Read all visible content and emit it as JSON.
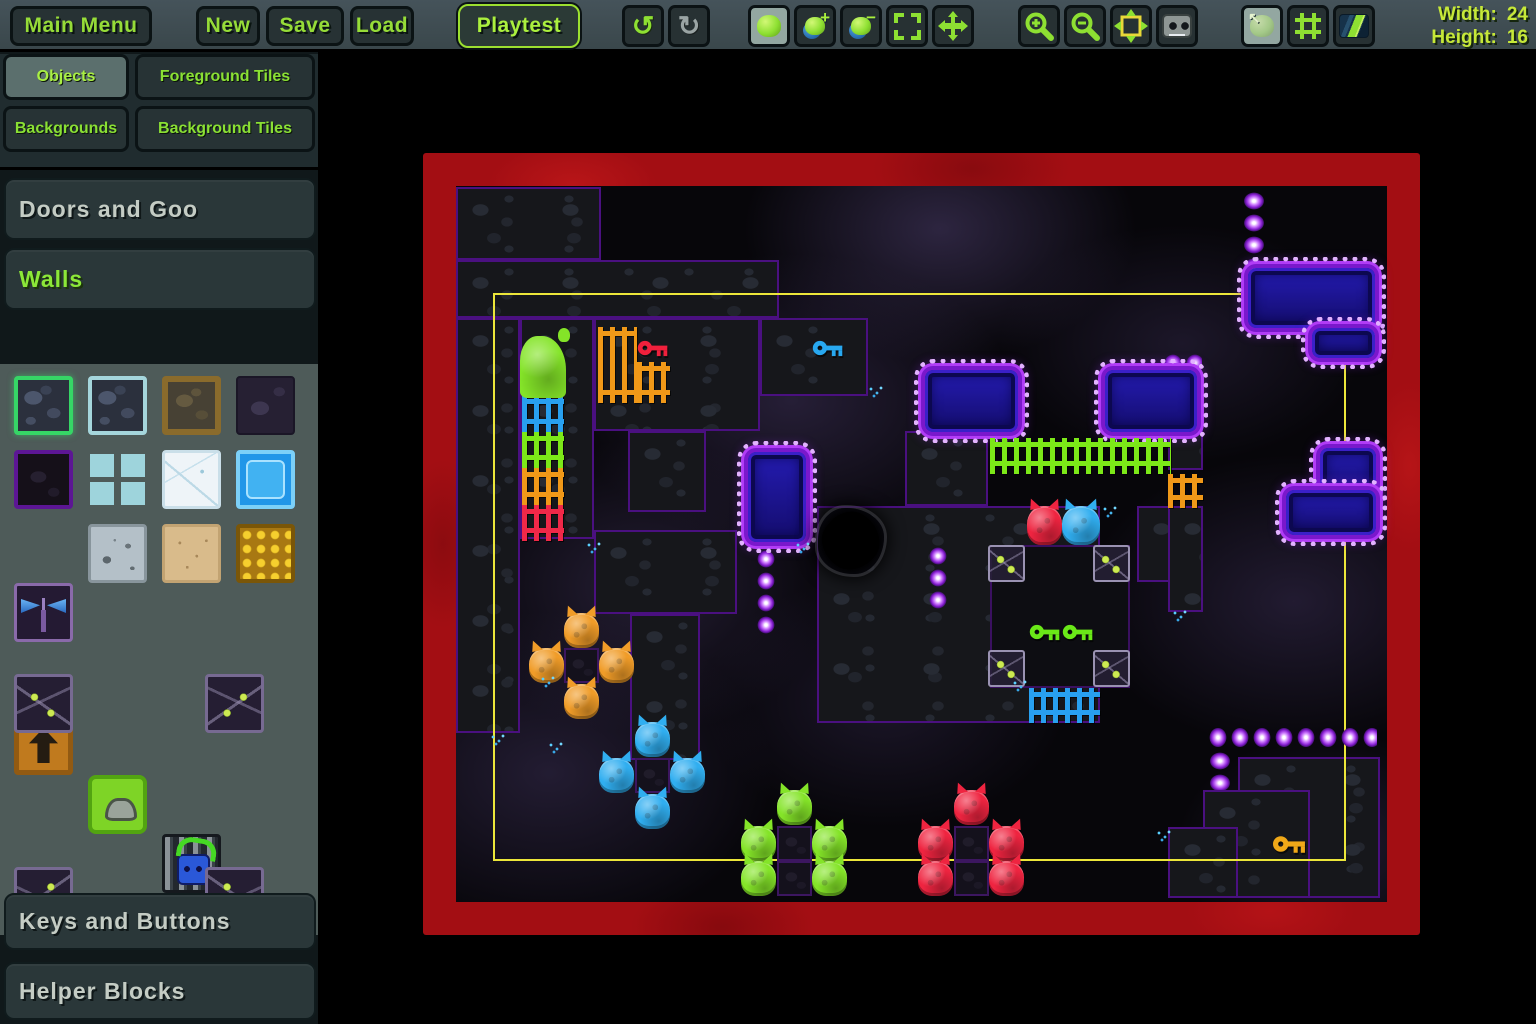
{
  "toolbar": {
    "buttons": [
      {
        "label": "Main Menu",
        "x": 10,
        "w": 142,
        "name": "main-menu-button"
      },
      {
        "label": "New",
        "x": 196,
        "w": 64,
        "name": "new-button"
      },
      {
        "label": "Save",
        "x": 266,
        "w": 78,
        "name": "save-button"
      },
      {
        "label": "Load",
        "x": 350,
        "w": 64,
        "name": "load-button"
      },
      {
        "label": "Playtest",
        "x": 458,
        "w": 122,
        "style": "playtest",
        "name": "playtest-button"
      }
    ],
    "icon_groups": [
      {
        "x": 622,
        "items": [
          {
            "icon": "undo",
            "enabled": true
          },
          {
            "icon": "redo",
            "enabled": false
          }
        ]
      },
      {
        "x": 748,
        "items": [
          {
            "icon": "brush-blob",
            "sel": true
          },
          {
            "icon": "blob-add"
          },
          {
            "icon": "blob-remove"
          },
          {
            "icon": "marquee-select"
          },
          {
            "icon": "move-view"
          }
        ]
      },
      {
        "x": 1018,
        "items": [
          {
            "icon": "zoom-in"
          },
          {
            "icon": "zoom-out"
          },
          {
            "icon": "fit-view"
          },
          {
            "icon": "toggle-faces"
          }
        ]
      },
      {
        "x": 1241,
        "items": [
          {
            "icon": "objects-layer",
            "sel": true
          },
          {
            "icon": "grid-toggle"
          },
          {
            "icon": "background-toggle"
          }
        ]
      }
    ],
    "size_info": {
      "width_label": "Width:",
      "width_value": "24",
      "height_label": "Height:",
      "height_value": "16"
    }
  },
  "sidebar": {
    "tabs": [
      {
        "label": "Objects",
        "x": 3,
        "y": 8,
        "w": 126,
        "h": 46,
        "sel": true
      },
      {
        "label": "Foreground Tiles",
        "x": 135,
        "y": 8,
        "w": 180,
        "h": 46
      },
      {
        "label": "Backgrounds",
        "x": 3,
        "y": 60,
        "w": 126,
        "h": 46
      },
      {
        "label": "Background Tiles",
        "x": 135,
        "y": 60,
        "w": 180,
        "h": 46
      }
    ],
    "sections": [
      {
        "label": "Doors and Goo",
        "y": 126,
        "h": 62,
        "expanded": false
      },
      {
        "label": "Walls",
        "y": 196,
        "h": 62,
        "expanded": true
      },
      {
        "label": "Keys and Buttons",
        "y": 841,
        "h": 57,
        "expanded": false
      },
      {
        "label": "Helper Blocks",
        "y": 910,
        "h": 58,
        "expanded": false
      }
    ],
    "palette": [
      {
        "n": "rock-green",
        "x": 14,
        "y": 272,
        "rock": true,
        "sel": true
      },
      {
        "n": "rock-crystal",
        "x": 88,
        "y": 272,
        "rock": true
      },
      {
        "n": "dirt-brown",
        "x": 162,
        "y": 272
      },
      {
        "n": "rock-shadow",
        "x": 236,
        "y": 272
      },
      {
        "n": "rock-purple",
        "x": 14,
        "y": 346
      },
      {
        "n": "mini-rocks",
        "x": 88,
        "y": 346
      },
      {
        "n": "ice-white",
        "x": 162,
        "y": 346
      },
      {
        "n": "ice-blue",
        "x": 236,
        "y": 346
      },
      {
        "n": "moth-block",
        "x": 14,
        "y": 420
      },
      {
        "n": "concrete",
        "x": 88,
        "y": 420
      },
      {
        "n": "sand",
        "x": 162,
        "y": 420
      },
      {
        "n": "honeycomb",
        "x": 236,
        "y": 420
      },
      {
        "n": "arrow-block",
        "x": 14,
        "y": 494
      },
      {
        "n": "goo-block",
        "x": 88,
        "y": 494
      },
      {
        "n": "door-block",
        "x": 162,
        "y": 494
      },
      {
        "n": "vine-corner",
        "variant": "v-tl",
        "x": 14,
        "y": 570
      },
      {
        "n": "vine-corner",
        "variant": "v-tr",
        "x": 205,
        "y": 570
      },
      {
        "n": "vine-corner",
        "variant": "v-bl",
        "x": 14,
        "y": 763
      },
      {
        "n": "vine-corner",
        "variant": "v-br",
        "x": 205,
        "y": 763
      }
    ]
  },
  "canvas": {
    "width_tiles": 24,
    "height_tiles": 16,
    "frame_color": "#a30e13",
    "bounds_color": "#ece63a",
    "objects": [
      {
        "n": "rock-region",
        "t": "rock",
        "x": 0,
        "y": 1,
        "w": 145,
        "h": 73
      },
      {
        "n": "rock-region",
        "t": "rock",
        "x": 0,
        "y": 74,
        "w": 323,
        "h": 58
      },
      {
        "n": "rock-region",
        "t": "rock",
        "x": 0,
        "y": 132,
        "w": 64,
        "h": 415
      },
      {
        "n": "rock-region",
        "t": "rock",
        "x": 64,
        "y": 132,
        "w": 74,
        "h": 221
      },
      {
        "n": "rock-region",
        "t": "rock",
        "x": 138,
        "y": 132,
        "w": 166,
        "h": 113
      },
      {
        "n": "rock-region",
        "t": "rock",
        "x": 304,
        "y": 132,
        "w": 108,
        "h": 78
      },
      {
        "n": "rock-region",
        "t": "rock",
        "x": 172,
        "y": 245,
        "w": 78,
        "h": 81
      },
      {
        "n": "rock-region",
        "t": "rock",
        "x": 138,
        "y": 344,
        "w": 143,
        "h": 84
      },
      {
        "n": "rock-region",
        "t": "rock",
        "x": 174,
        "y": 428,
        "w": 70,
        "h": 146
      },
      {
        "n": "rock-region",
        "t": "rock",
        "x": 449,
        "y": 245,
        "w": 83,
        "h": 75
      },
      {
        "n": "rock-region",
        "t": "rock",
        "x": 361,
        "y": 320,
        "w": 283,
        "h": 217
      },
      {
        "n": "rock-region",
        "t": "rock",
        "x": 681,
        "y": 320,
        "w": 35,
        "h": 76
      },
      {
        "n": "rock-region",
        "t": "rock",
        "x": 712,
        "y": 214,
        "w": 35,
        "h": 70
      },
      {
        "n": "rock-region",
        "t": "rock",
        "x": 712,
        "y": 320,
        "w": 35,
        "h": 106
      },
      {
        "n": "rock-region",
        "t": "rock",
        "x": 782,
        "y": 571,
        "w": 142,
        "h": 141
      },
      {
        "n": "rock-region",
        "t": "rock",
        "x": 747,
        "y": 604,
        "w": 107,
        "h": 108
      },
      {
        "n": "rock-region",
        "t": "rock",
        "x": 712,
        "y": 641,
        "w": 70,
        "h": 71
      },
      {
        "n": "black-room",
        "t": "blackpatch",
        "x": 534,
        "y": 359,
        "w": 140,
        "h": 143
      },
      {
        "n": "level-bounds",
        "t": "bounds",
        "x": 37,
        "y": 107,
        "w": 853,
        "h": 568
      },
      {
        "n": "diamond-chain",
        "t": "chainV",
        "x": 785,
        "y": 4,
        "w": 26,
        "h": 103
      },
      {
        "n": "diamond-chain",
        "t": "chainV",
        "x": 471,
        "y": 359,
        "w": 22,
        "h": 67
      },
      {
        "n": "diamond-chain",
        "t": "chainV",
        "x": 299,
        "y": 362,
        "w": 22,
        "h": 87
      },
      {
        "n": "diamond-chain",
        "t": "chainH",
        "x": 751,
        "y": 539,
        "w": 170,
        "h": 25
      },
      {
        "n": "diamond-chain",
        "t": "chainV",
        "x": 751,
        "y": 564,
        "w": 26,
        "h": 40
      },
      {
        "n": "diamond-chain",
        "t": "chainH",
        "x": 706,
        "y": 166,
        "w": 40,
        "h": 22
      },
      {
        "n": "spike-wall",
        "t": "spike",
        "x": 469,
        "y": 184,
        "w": 93,
        "h": 62
      },
      {
        "n": "spike-wall",
        "t": "spike",
        "x": 649,
        "y": 184,
        "w": 92,
        "h": 62
      },
      {
        "n": "spike-wall",
        "t": "spike",
        "x": 292,
        "y": 266,
        "w": 58,
        "h": 90
      },
      {
        "n": "spike-wall",
        "t": "spike",
        "x": 792,
        "y": 82,
        "w": 127,
        "h": 60
      },
      {
        "n": "spike-wall",
        "t": "spike",
        "x": 856,
        "y": 142,
        "w": 63,
        "h": 30
      },
      {
        "n": "spike-wall",
        "t": "spike",
        "x": 864,
        "y": 262,
        "w": 56,
        "h": 52
      },
      {
        "n": "spike-wall",
        "t": "spike",
        "x": 830,
        "y": 304,
        "w": 90,
        "h": 45
      },
      {
        "n": "splat",
        "t": "splat",
        "x": 362,
        "y": 322,
        "w": 66,
        "h": 66
      },
      {
        "n": "fence-green",
        "t": "fence",
        "x": 534,
        "y": 252,
        "w": 181,
        "h": 36,
        "c": "#7ce818"
      },
      {
        "n": "fence-orange",
        "t": "fence",
        "x": 712,
        "y": 288,
        "w": 35,
        "h": 34,
        "c": "#f09818"
      },
      {
        "n": "fence-blue",
        "t": "fence",
        "x": 573,
        "y": 502,
        "w": 71,
        "h": 35,
        "c": "#28a0f0"
      },
      {
        "n": "fence-orange",
        "t": "fence",
        "x": 142,
        "y": 141,
        "w": 39,
        "h": 76,
        "c": "#f09818"
      },
      {
        "n": "fence-orange",
        "t": "fence",
        "x": 181,
        "y": 176,
        "w": 33,
        "h": 41,
        "c": "#f09818"
      },
      {
        "n": "goo-ladder",
        "t": "ladder",
        "x": 66,
        "y": 209,
        "w": 42,
        "h": 146,
        "segs": [
          "#28a0f0",
          "#7ce818",
          "#f09818",
          "#f02848"
        ]
      },
      {
        "n": "goo-drip-green",
        "t": "gooDrip",
        "x": 64,
        "y": 150,
        "w": 46,
        "h": 62,
        "c": "#84e428"
      },
      {
        "n": "vine-tile",
        "t": "vine",
        "x": 532,
        "y": 359,
        "w": 37,
        "h": 37
      },
      {
        "n": "vine-tile",
        "t": "vine",
        "x": 637,
        "y": 359,
        "w": 37,
        "h": 37
      },
      {
        "n": "vine-tile",
        "t": "vine",
        "x": 532,
        "y": 464,
        "w": 37,
        "h": 37
      },
      {
        "n": "vine-tile",
        "t": "vine",
        "x": 637,
        "y": 464,
        "w": 37,
        "h": 37
      },
      {
        "n": "dark-tile",
        "t": "darktile",
        "x": 108,
        "y": 462,
        "w": 35,
        "h": 35
      },
      {
        "n": "dark-tile",
        "t": "darktile",
        "x": 179,
        "y": 572,
        "w": 35,
        "h": 35
      },
      {
        "n": "dark-tile",
        "t": "darktile",
        "x": 321,
        "y": 640,
        "w": 35,
        "h": 35
      },
      {
        "n": "dark-tile",
        "t": "darktile",
        "x": 321,
        "y": 675,
        "w": 35,
        "h": 35
      },
      {
        "n": "dark-tile",
        "t": "darktile",
        "x": 498,
        "y": 640,
        "w": 35,
        "h": 35
      },
      {
        "n": "dark-tile",
        "t": "darktile",
        "x": 498,
        "y": 675,
        "w": 35,
        "h": 35
      },
      {
        "n": "goo-red",
        "t": "goo",
        "x": 571,
        "y": 320,
        "w": 35,
        "h": 39,
        "c": "#ef2440"
      },
      {
        "n": "goo-blue",
        "t": "goo",
        "x": 606,
        "y": 320,
        "w": 38,
        "h": 39,
        "c": "#30aef0"
      },
      {
        "n": "goo-orange",
        "t": "goo",
        "x": 108,
        "y": 427,
        "w": 35,
        "h": 35,
        "c": "#f09c28"
      },
      {
        "n": "goo-orange",
        "t": "goo",
        "x": 73,
        "y": 462,
        "w": 35,
        "h": 35,
        "c": "#f09c28"
      },
      {
        "n": "goo-orange",
        "t": "goo",
        "x": 143,
        "y": 462,
        "w": 35,
        "h": 35,
        "c": "#f09c28"
      },
      {
        "n": "goo-orange",
        "t": "goo",
        "x": 108,
        "y": 498,
        "w": 35,
        "h": 35,
        "c": "#f09c28"
      },
      {
        "n": "goo-blue",
        "t": "goo",
        "x": 179,
        "y": 536,
        "w": 35,
        "h": 35,
        "c": "#30aef0"
      },
      {
        "n": "goo-blue",
        "t": "goo",
        "x": 143,
        "y": 572,
        "w": 35,
        "h": 35,
        "c": "#30aef0"
      },
      {
        "n": "goo-blue",
        "t": "goo",
        "x": 214,
        "y": 572,
        "w": 35,
        "h": 35,
        "c": "#30aef0"
      },
      {
        "n": "goo-blue",
        "t": "goo",
        "x": 179,
        "y": 608,
        "w": 35,
        "h": 35,
        "c": "#30aef0"
      },
      {
        "n": "goo-green",
        "t": "goo",
        "x": 321,
        "y": 604,
        "w": 35,
        "h": 35,
        "c": "#84e428"
      },
      {
        "n": "goo-green",
        "t": "goo",
        "x": 285,
        "y": 640,
        "w": 35,
        "h": 35,
        "c": "#84e428"
      },
      {
        "n": "goo-green",
        "t": "goo",
        "x": 356,
        "y": 640,
        "w": 35,
        "h": 35,
        "c": "#84e428"
      },
      {
        "n": "goo-green",
        "t": "goo",
        "x": 285,
        "y": 675,
        "w": 35,
        "h": 35,
        "c": "#84e428"
      },
      {
        "n": "goo-green",
        "t": "goo",
        "x": 356,
        "y": 675,
        "w": 35,
        "h": 35,
        "c": "#84e428"
      },
      {
        "n": "goo-red",
        "t": "goo",
        "x": 498,
        "y": 604,
        "w": 35,
        "h": 35,
        "c": "#ef2440"
      },
      {
        "n": "goo-red",
        "t": "goo",
        "x": 462,
        "y": 640,
        "w": 35,
        "h": 35,
        "c": "#ef2440"
      },
      {
        "n": "goo-red",
        "t": "goo",
        "x": 533,
        "y": 640,
        "w": 35,
        "h": 35,
        "c": "#ef2440"
      },
      {
        "n": "goo-red",
        "t": "goo",
        "x": 462,
        "y": 675,
        "w": 35,
        "h": 35,
        "c": "#ef2440"
      },
      {
        "n": "goo-red",
        "t": "goo",
        "x": 533,
        "y": 675,
        "w": 35,
        "h": 35,
        "c": "#ef2440"
      },
      {
        "n": "key-red",
        "t": "key",
        "x": 181,
        "y": 152,
        "w": 33,
        "h": 20,
        "c": "#f0203c"
      },
      {
        "n": "key-blue",
        "t": "key",
        "x": 356,
        "y": 152,
        "w": 33,
        "h": 20,
        "c": "#28a8f0"
      },
      {
        "n": "key-green",
        "t": "key",
        "x": 573,
        "y": 436,
        "w": 33,
        "h": 20,
        "c": "#6ae818"
      },
      {
        "n": "key-green",
        "t": "key",
        "x": 606,
        "y": 436,
        "w": 33,
        "h": 20,
        "c": "#6ae818"
      },
      {
        "n": "key-orange",
        "t": "key",
        "x": 817,
        "y": 647,
        "w": 34,
        "h": 22,
        "c": "#f0a818"
      },
      {
        "n": "drip",
        "t": "drip",
        "x": 84,
        "y": 490,
        "w": 16,
        "h": 12
      },
      {
        "n": "drip",
        "t": "drip",
        "x": 130,
        "y": 356,
        "w": 16,
        "h": 12
      },
      {
        "n": "drip",
        "t": "drip",
        "x": 339,
        "y": 356,
        "w": 16,
        "h": 12
      },
      {
        "n": "drip",
        "t": "drip",
        "x": 646,
        "y": 320,
        "w": 16,
        "h": 12
      },
      {
        "n": "drip",
        "t": "drip",
        "x": 716,
        "y": 424,
        "w": 16,
        "h": 12
      },
      {
        "n": "drip",
        "t": "drip",
        "x": 700,
        "y": 644,
        "w": 16,
        "h": 12
      },
      {
        "n": "drip",
        "t": "drip",
        "x": 556,
        "y": 494,
        "w": 16,
        "h": 12
      },
      {
        "n": "drip",
        "t": "drip",
        "x": 412,
        "y": 200,
        "w": 16,
        "h": 12
      },
      {
        "n": "drip",
        "t": "drip",
        "x": 34,
        "y": 548,
        "w": 16,
        "h": 12
      },
      {
        "n": "drip",
        "t": "drip",
        "x": 92,
        "y": 556,
        "w": 16,
        "h": 12
      }
    ]
  }
}
